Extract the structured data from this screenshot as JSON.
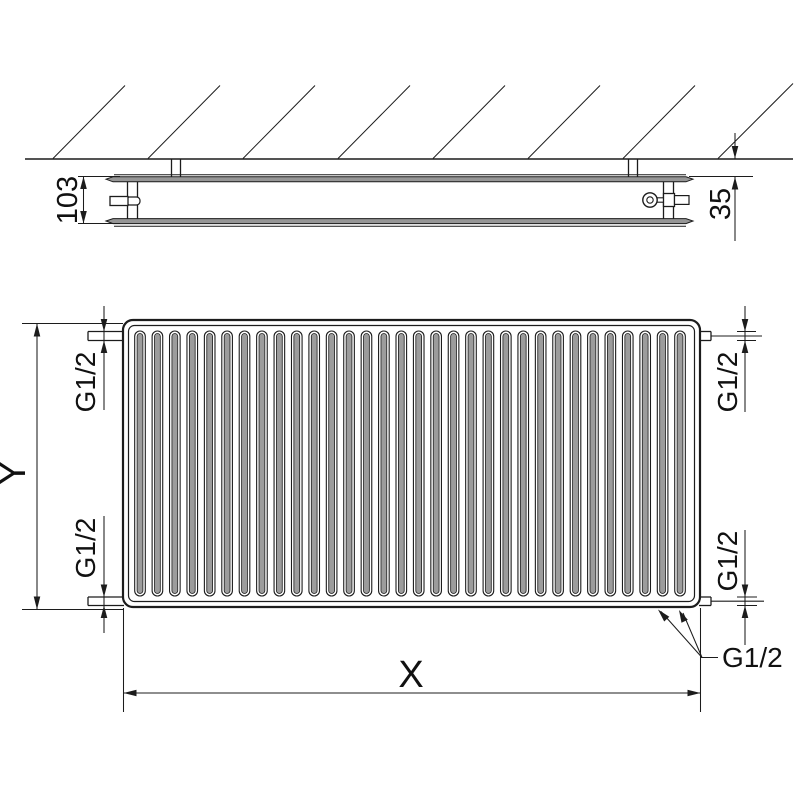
{
  "colors": {
    "line": "#1c1c1c",
    "panel_fill": "#969696",
    "fin_fill": "#9c9c9c",
    "background": "#ffffff"
  },
  "top_view": {
    "depth_label": "103",
    "wall_distance_label": "35"
  },
  "front_view": {
    "height_label": "Y",
    "width_label": "X",
    "fin_count": 32,
    "thread_labels": {
      "top_left": "G1/2",
      "bottom_left": "G1/2",
      "top_right": "G1/2",
      "bottom_right": "G1/2",
      "bottom_connections": "G1/2"
    }
  }
}
